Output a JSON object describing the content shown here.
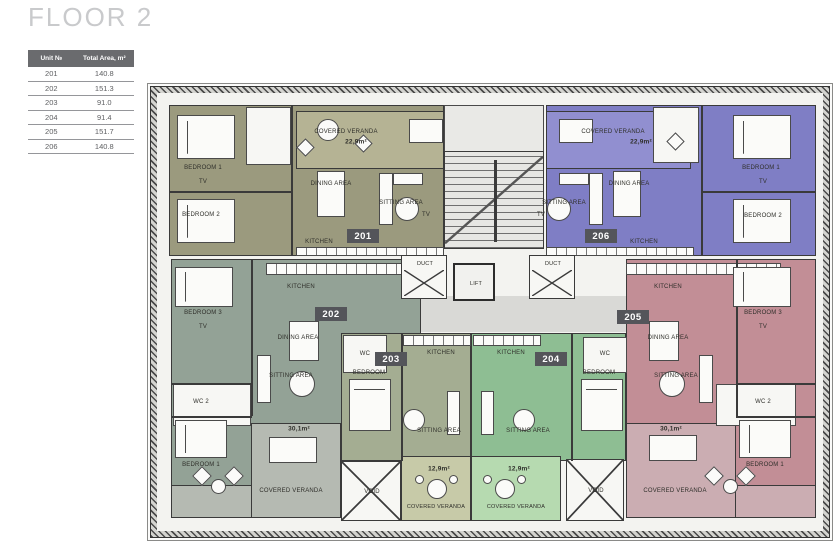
{
  "title": "FLOOR 2",
  "table": {
    "headers": [
      "Unit №",
      "Total Area, m²"
    ],
    "rows": [
      {
        "unit": "201",
        "area": "140.8"
      },
      {
        "unit": "202",
        "area": "151.3"
      },
      {
        "unit": "203",
        "area": "91.0"
      },
      {
        "unit": "204",
        "area": "91.4"
      },
      {
        "unit": "205",
        "area": "151.7"
      },
      {
        "unit": "206",
        "area": "140.8"
      }
    ]
  },
  "units": {
    "u201": "201",
    "u202": "202",
    "u203": "203",
    "u204": "204",
    "u205": "205",
    "u206": "206"
  },
  "labels": {
    "covered_veranda": "COVERED VERANDA",
    "dining_area": "DINING AREA",
    "sitting_area": "SITTING AREA",
    "kitchen": "KITCHEN",
    "bedroom": "BEDROOM",
    "bedroom_1": "BEDROOM 1",
    "bedroom_2": "BEDROOM 2",
    "bedroom_3": "BEDROOM 3",
    "tv": "TV",
    "wc": "WC",
    "wc_2": "WC 2",
    "lift": "LIFT",
    "duct": "DUCT",
    "void": "VOID"
  },
  "areas": {
    "veranda_201": "22,9m²",
    "veranda_206": "22,9m²",
    "veranda_202": "30,1m²",
    "veranda_205": "30,1m²",
    "veranda_203": "12,9m²",
    "veranda_204": "12,9m²"
  },
  "colors": {
    "unit_201": "#9b9a7e",
    "unit_202": "#93a296",
    "unit_203": "#a4ad92",
    "unit_204": "#8ebe93",
    "unit_205": "#c28e96",
    "unit_206": "#7f7ec5",
    "veranda_201": "#b5b394",
    "veranda_202": "#b5bab2",
    "veranda_203": "#c7caa8",
    "veranda_204": "#b6dab0",
    "veranda_205": "#cbadb2",
    "veranda_206": "#918fd0",
    "badge_bg": "#54555a",
    "table_header_bg": "#6a6b6e",
    "wall": "#3a3a3a"
  }
}
